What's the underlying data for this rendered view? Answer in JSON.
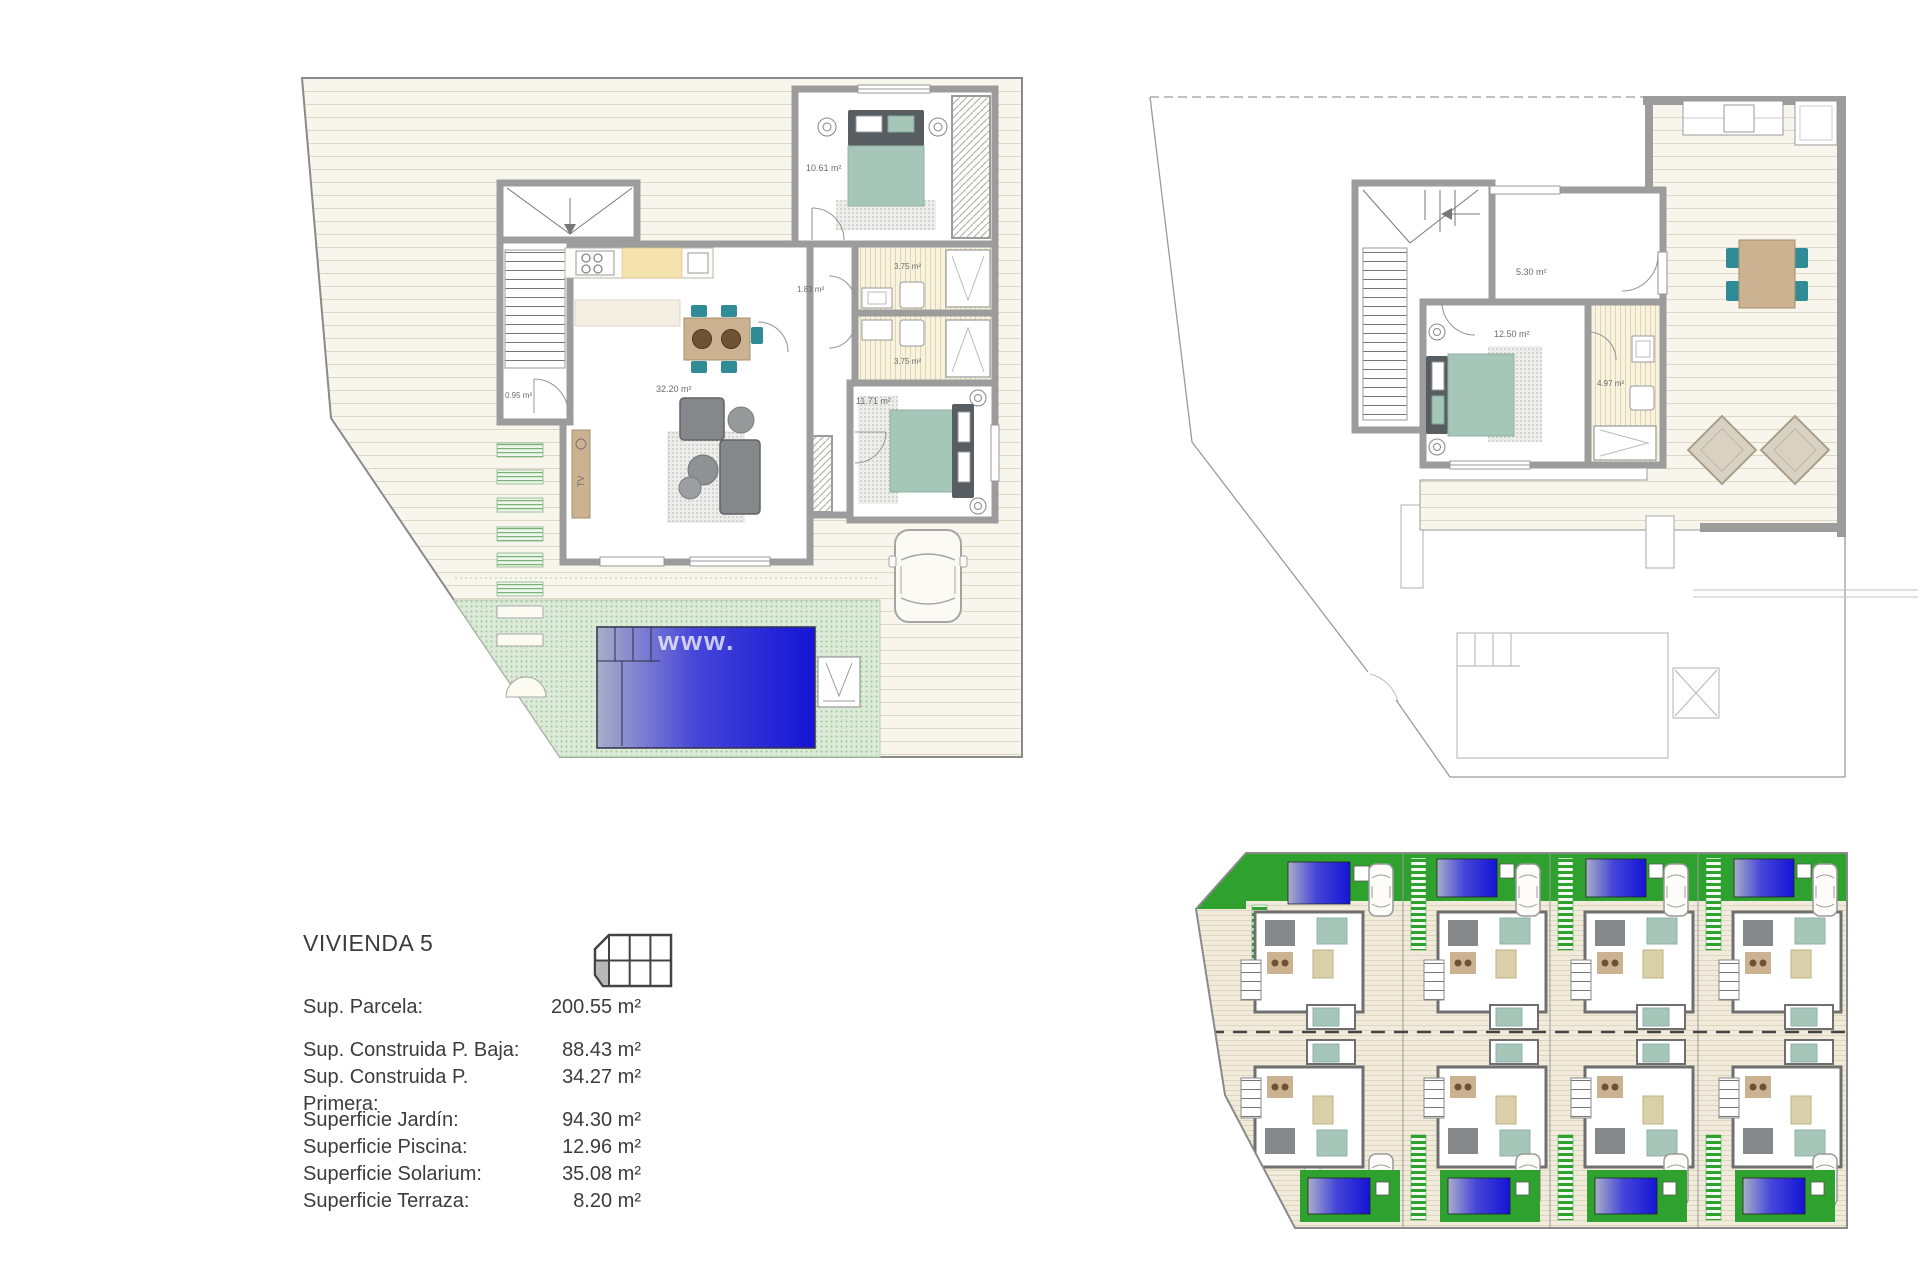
{
  "sheet_title": "VIVIENDA 5",
  "watermark": "www.",
  "info": {
    "title": "VIVIENDA 5",
    "rows": [
      {
        "label": "Sup. Parcela:",
        "value": "200.55 m²"
      },
      {
        "label": "Sup. Construida P. Baja:",
        "value": "88.43 m²"
      },
      {
        "label": "Sup. Construida P. Primera:",
        "value": "34.27 m²"
      },
      {
        "label": "Superficie Jardín:",
        "value": "94.30 m²"
      },
      {
        "label": "Superficie Piscina:",
        "value": "12.96 m²"
      },
      {
        "label": "Superficie Solarium:",
        "value": "35.08 m²"
      },
      {
        "label": "Superficie Terraza:",
        "value": "8.20 m²"
      }
    ]
  },
  "plan_ground": {
    "labels": {
      "entry": "0.95 m²",
      "living": "32.20 m²",
      "hall": "1.83 m²",
      "bath_top": "3.75 m²",
      "bath_bottom": "3.75 m²",
      "bedroom_top": "10.61 m²",
      "bedroom_right": "11.71 m²",
      "tv": "TV"
    }
  },
  "plan_first": {
    "labels": {
      "hall": "5.30 m²",
      "bedroom": "12.50 m²",
      "bath": "4.97 m²"
    }
  },
  "colors": {
    "pool_blue": "#1a1ad6",
    "site_green": "#2ea12e",
    "furniture_teal": "#a6c6ba",
    "chair_teal": "#2f8b96",
    "wood_tan": "#cbb290",
    "wall_gray": "#9c9c9c",
    "deck_cream": "#f8f6ec"
  }
}
